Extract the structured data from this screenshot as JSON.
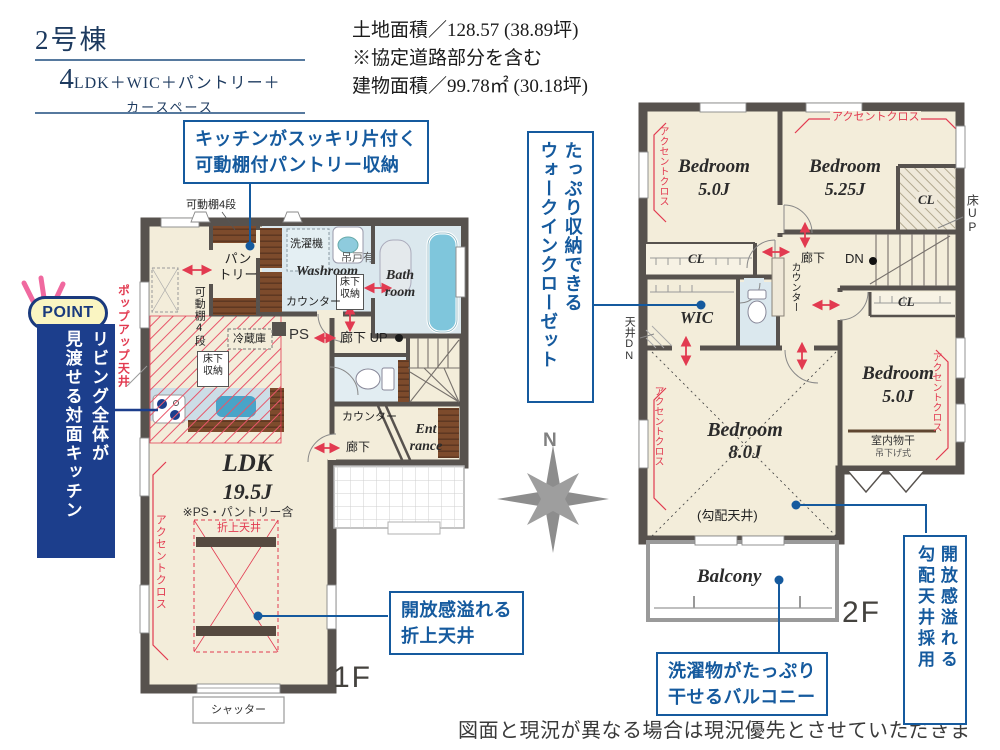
{
  "header": {
    "building_no": "2号棟",
    "layout_big": "4",
    "layout_rest": "LDK＋WIC＋パントリー＋",
    "layout_line2": "カースペース",
    "land_area": "土地面積／128.57 (38.89坪)",
    "land_note": "※協定道路部分を含む",
    "building_area": "建物面積／99.78㎡ (30.18坪)"
  },
  "point": {
    "badge": "POINT",
    "text_col1": "リビング全体が",
    "text_col2": "見渡せる対面キッチン",
    "popup_ceiling": "ポップアップ天井"
  },
  "callouts": {
    "pantry_line1": "キッチンがスッキリ片付く",
    "pantry_line2": "可動棚付パントリー収納",
    "wic_col1": "たっぷり収納できる",
    "wic_col2": "ウォークインクローゼット",
    "ldk_ceiling_line1": "開放感溢れる",
    "ldk_ceiling_line2": "折上天井",
    "balcony_line1": "洗濯物がたっぷり",
    "balcony_line2": "干せるバルコニー",
    "sloped_col1": "開放感溢れる",
    "sloped_col2": "勾配天井採用"
  },
  "floor1": {
    "label": "1F",
    "ldk_name": "LDK",
    "ldk_size": "19.5J",
    "ldk_note": "※PS・パントリー含",
    "pantry_l1": "パン",
    "pantry_l2": "トリー",
    "washroom": "Washroom",
    "bath_l1": "Bath",
    "bath_l2": "room",
    "entrance_l1": "Ent",
    "entrance_l2": "rance",
    "shelf_top": "可動棚4段",
    "shelf_side": "可動棚4段",
    "washer": "洗濯機",
    "hanging_cab": "吊戸有",
    "counter_wash": "カウンター",
    "counter_ent": "カウンター",
    "underfloor_l1": "床下",
    "underfloor_l2": "収納",
    "fridge": "冷蔵庫",
    "ps": "PS",
    "hall_up": "廊下 UP",
    "hall": "廊下",
    "folded_ceiling": "折上天井",
    "accent": "アクセントクロス",
    "shutter": "シャッター"
  },
  "floor2": {
    "label": "2F",
    "bedroom": "Bedroom",
    "b1_size": "5.0J",
    "b2_size": "5.25J",
    "b3_size": "8.0J",
    "b4_size": "5.0J",
    "wic": "WIC",
    "cl": "CL",
    "hall": "廊下",
    "dn": "DN",
    "counter": "カウンター",
    "ceiling_dn": "天井DN",
    "floor_up": "床UP",
    "sloped": "(勾配天井)",
    "drying_l1": "室内物干",
    "drying_l2": "吊下げ式",
    "balcony": "Balcony",
    "accent": "アクセントクロス"
  },
  "compass": {
    "n": "N"
  },
  "footer": {
    "disclaimer": "図面と現況が異なる場合は現況優先とさせていただきます。"
  },
  "colors": {
    "callout_blue": "#155a9e",
    "navy": "#1c3e8c",
    "accent_red": "#e23a50",
    "wall": "#57524e",
    "floor": "#f3edda",
    "wet": "#dbe8ee",
    "tub": "#7fc6dc",
    "wood": "#7d4b2c"
  }
}
